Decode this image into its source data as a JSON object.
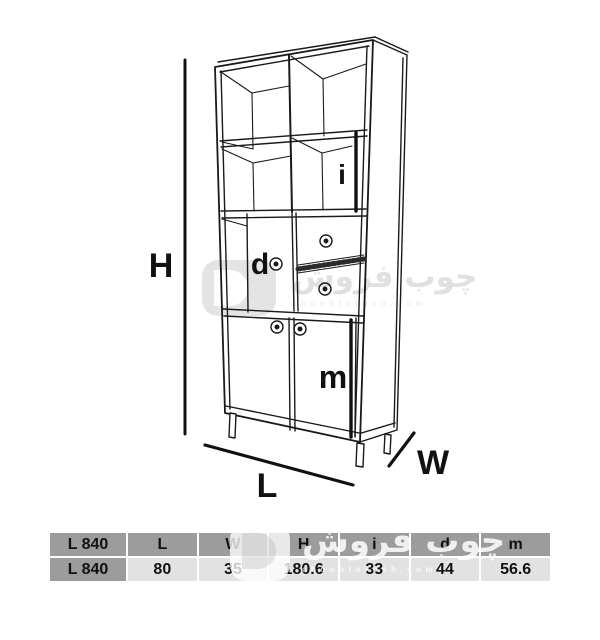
{
  "diagram": {
    "labels": {
      "height": "H",
      "length": "L",
      "width": "W",
      "inner_shelf": "i",
      "door": "d",
      "module": "m"
    }
  },
  "table": {
    "headers": [
      "L 840",
      "L",
      "W",
      "H",
      "i",
      "d",
      "m"
    ],
    "rows": [
      [
        "L 840",
        "80",
        "35",
        "180.6",
        "33",
        "44",
        "56.6"
      ]
    ]
  },
  "watermark": {
    "brand": "چوب فروش",
    "domain": "choobforosh.com"
  },
  "colors": {
    "table_header_bg": "#9c9c9c",
    "table_row_bg": "#e2e2e2",
    "line": "#1a1a1a"
  }
}
